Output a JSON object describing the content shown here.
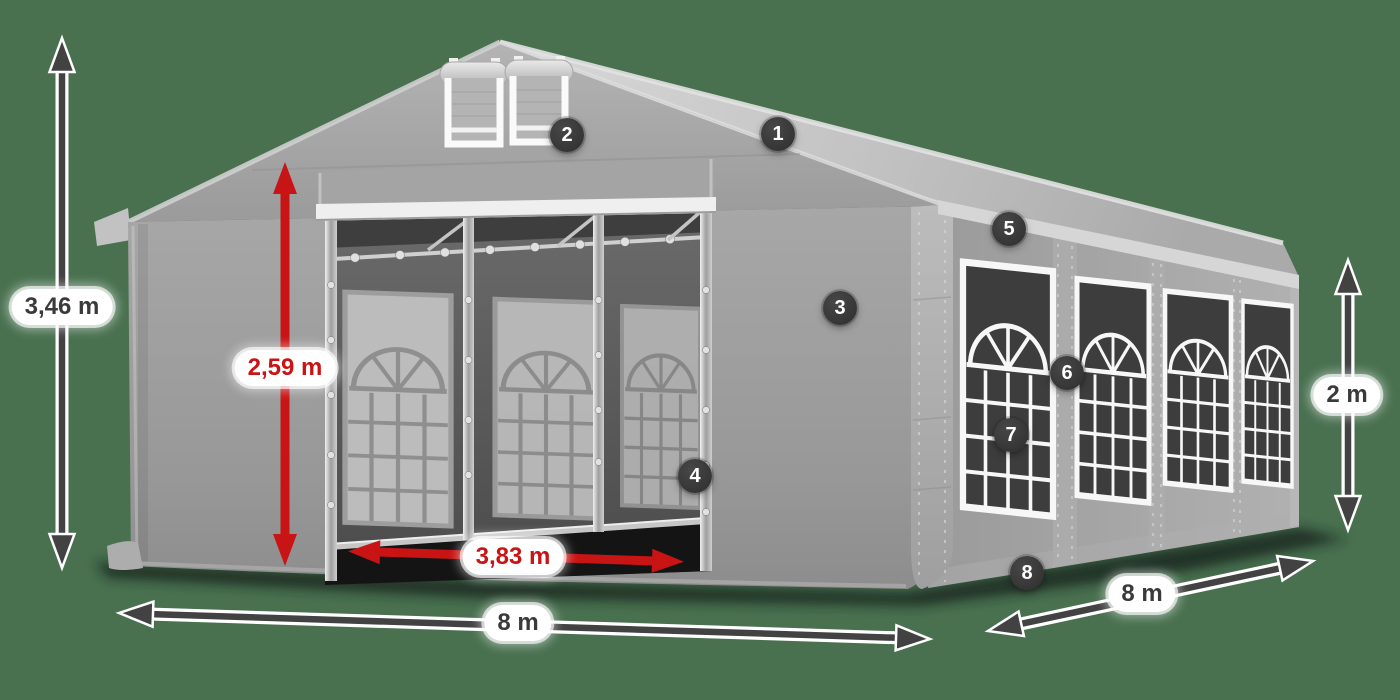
{
  "diagram": {
    "name": "Party tent with dimension callouts",
    "background_color": "#497150",
    "accent_red": "#c81414",
    "text_dark": "#3a3a3a",
    "badge_color": "#333333"
  },
  "dimensions": {
    "total_height": "3,46 m",
    "entrance_height": "2,59 m",
    "entrance_width": "3,83 m",
    "front_width": "8 m",
    "side_length": "8 m",
    "side_wall_height": "2 m"
  },
  "badges": [
    {
      "number": "1"
    },
    {
      "number": "2"
    },
    {
      "number": "3"
    },
    {
      "number": "4"
    },
    {
      "number": "5"
    },
    {
      "number": "6"
    },
    {
      "number": "7"
    },
    {
      "number": "8"
    }
  ]
}
